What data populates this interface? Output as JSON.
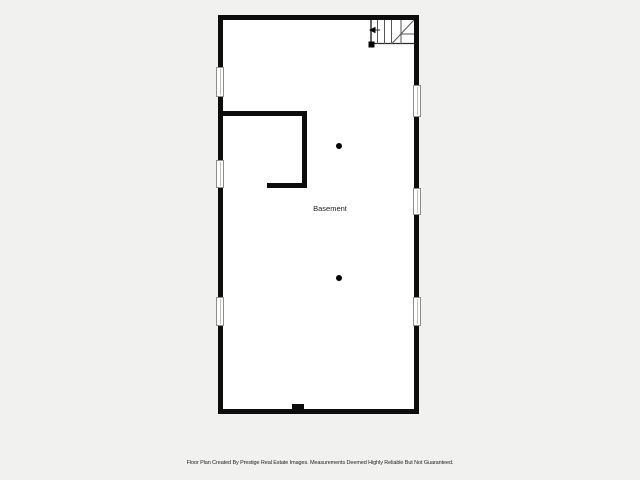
{
  "floor_plan": {
    "room_label": "Basement",
    "disclaimer": "Floor Plan Created By Prestige Real Estate Images. Measurements Deemed Highly Reliable But Not Guaranteed.",
    "colors": {
      "background": "#f1f1ef",
      "interior": "#ffffff",
      "wall": "#0d0d0d",
      "window_fill": "#ffffff",
      "window_frame": "#8d8d8d",
      "window_pane_line": "#bfbfbf",
      "stair_edge": "#2e2e2e",
      "stair_tread": "#555555",
      "marker": "#000000",
      "text": "#1d1d1d"
    },
    "geometry": {
      "canvas": {
        "w": 640,
        "h": 480
      },
      "interior": {
        "x": 221,
        "y": 18,
        "w": 196,
        "h": 394
      },
      "walls": [
        {
          "x": 218,
          "y": 15,
          "w": 201,
          "h": 5
        },
        {
          "x": 218,
          "y": 409,
          "w": 201,
          "h": 5
        },
        {
          "x": 218,
          "y": 15,
          "w": 5,
          "h": 52
        },
        {
          "x": 218,
          "y": 97,
          "w": 5,
          "h": 63
        },
        {
          "x": 218,
          "y": 188,
          "w": 5,
          "h": 109
        },
        {
          "x": 218,
          "y": 326,
          "w": 5,
          "h": 88
        },
        {
          "x": 414,
          "y": 15,
          "w": 5,
          "h": 70
        },
        {
          "x": 414,
          "y": 117,
          "w": 5,
          "h": 71
        },
        {
          "x": 414,
          "y": 215,
          "w": 5,
          "h": 82
        },
        {
          "x": 414,
          "y": 326,
          "w": 5,
          "h": 88
        },
        {
          "x": 223,
          "y": 111,
          "w": 84,
          "h": 5
        },
        {
          "x": 302,
          "y": 111,
          "w": 5,
          "h": 77
        },
        {
          "x": 267,
          "y": 183,
          "w": 40,
          "h": 5
        },
        {
          "x": 292,
          "y": 404,
          "w": 12,
          "h": 6
        }
      ],
      "windows": [
        {
          "x": 216,
          "y": 67,
          "w": 8,
          "h": 30
        },
        {
          "x": 216,
          "y": 160,
          "w": 8,
          "h": 28
        },
        {
          "x": 216,
          "y": 297,
          "w": 8,
          "h": 29
        },
        {
          "x": 413,
          "y": 85,
          "w": 8,
          "h": 32
        },
        {
          "x": 413,
          "y": 188,
          "w": 8,
          "h": 27
        },
        {
          "x": 413,
          "y": 297,
          "w": 8,
          "h": 29
        }
      ],
      "columns": [
        {
          "cx": 338.5,
          "cy": 145.5,
          "r": 3
        },
        {
          "cx": 339,
          "cy": 278,
          "r": 3.2
        }
      ],
      "stairs": {
        "lines": [
          {
            "x1": 371,
            "y1": 20,
            "x2": 371,
            "y2": 44,
            "w": 1.5,
            "tone": "edge"
          },
          {
            "x1": 370,
            "y1": 43.5,
            "x2": 414,
            "y2": 43.5,
            "w": 1.2,
            "tone": "edge"
          },
          {
            "x1": 377.5,
            "y1": 20,
            "x2": 377.5,
            "y2": 44,
            "w": 1,
            "tone": "tread"
          },
          {
            "x1": 384.5,
            "y1": 20,
            "x2": 384.5,
            "y2": 44,
            "w": 1,
            "tone": "tread"
          },
          {
            "x1": 391.5,
            "y1": 20,
            "x2": 391.5,
            "y2": 44,
            "w": 1,
            "tone": "tread"
          },
          {
            "x1": 401,
            "y1": 20,
            "x2": 401,
            "y2": 44,
            "w": 1,
            "tone": "tread"
          },
          {
            "x1": 391.5,
            "y1": 44,
            "x2": 414,
            "y2": 20,
            "w": 1,
            "tone": "tread"
          },
          {
            "x1": 401,
            "y1": 34,
            "x2": 414,
            "y2": 34,
            "w": 1,
            "tone": "tread"
          },
          {
            "x1": 372,
            "y1": 30,
            "x2": 380,
            "y2": 30,
            "w": 1,
            "tone": "edge"
          }
        ],
        "arrow_head": {
          "points": "369,30 375.5,26.8 375.5,33.2"
        },
        "newel_square": {
          "x": 368.5,
          "y": 41.5,
          "s": 6
        }
      }
    }
  }
}
